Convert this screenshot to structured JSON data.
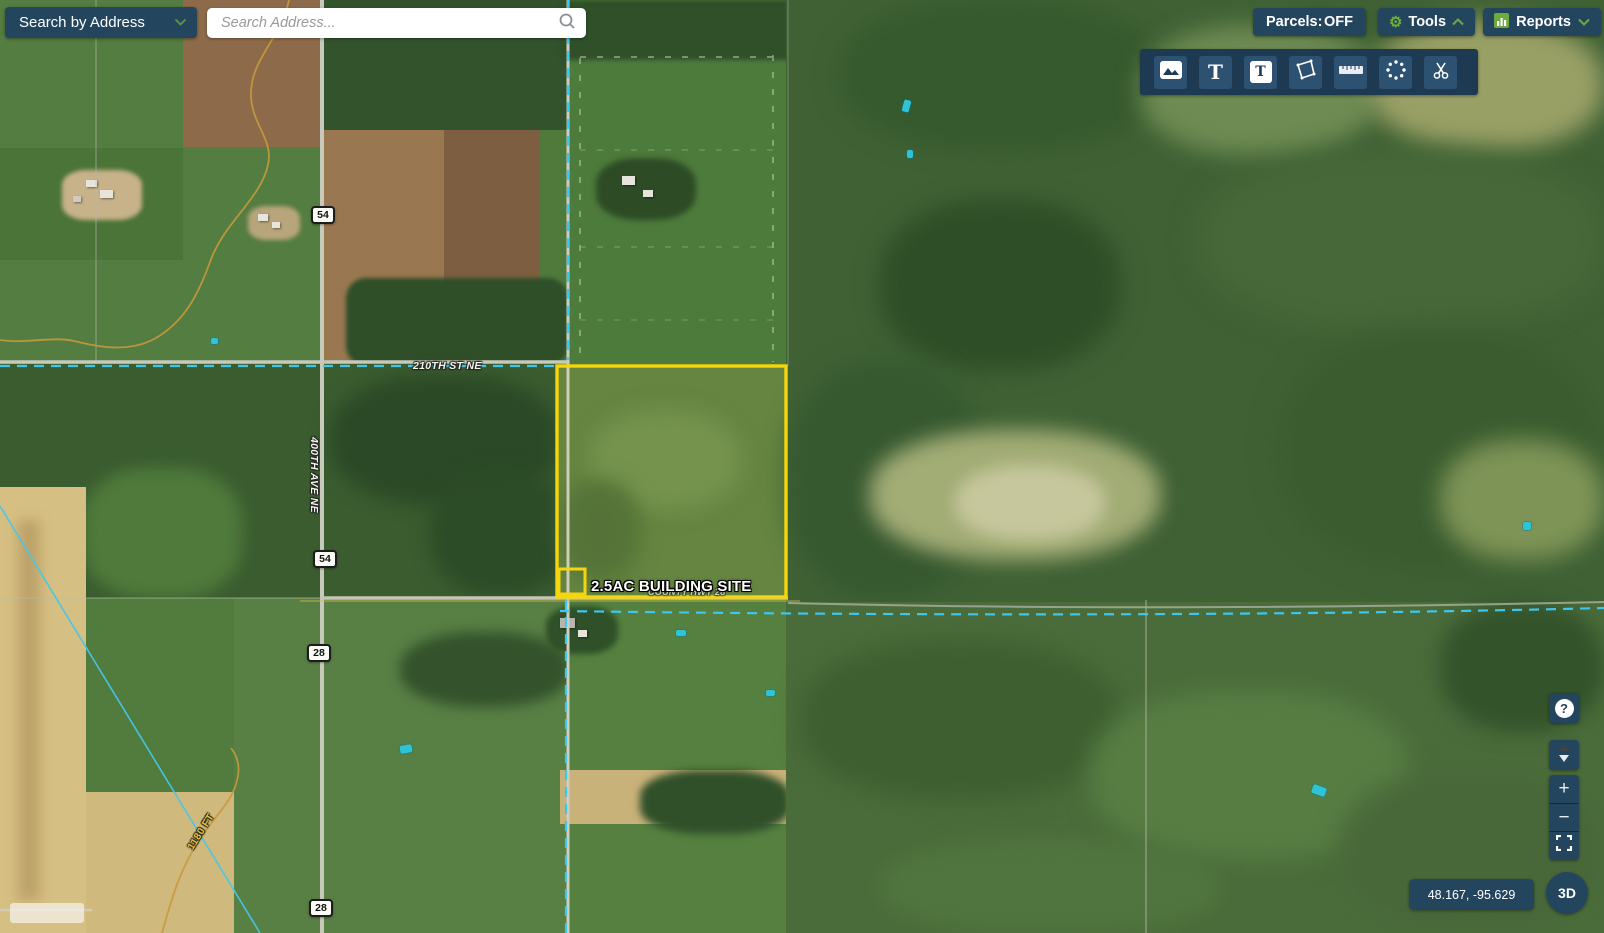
{
  "search": {
    "mode_button_label": "Search by Address",
    "placeholder": "Search Address..."
  },
  "topbar": {
    "parcels_label": "Parcels:",
    "parcels_state": "OFF",
    "tools_label": "Tools",
    "reports_label": "Reports"
  },
  "toolbar": {
    "text_tool_glyph": "T",
    "text_box_tool_glyph": "T"
  },
  "map": {
    "site_label": "2.5AC BUILDING SITE",
    "road_210": "210TH ST NE",
    "road_400": "400TH AVE NE",
    "road_hwy": "COUNTY HWY 28",
    "shields": [
      {
        "number": "54"
      },
      {
        "number": "54"
      },
      {
        "number": "28"
      },
      {
        "number": "28"
      }
    ],
    "contour_label": "1180 FT"
  },
  "controls": {
    "help_glyph": "?",
    "zoom_in_glyph": "+",
    "zoom_out_glyph": "−",
    "coordinates": "48.167, -95.629",
    "view_3d_label": "3D"
  },
  "colors": {
    "panel_navy": "#24455e",
    "accent_green": "#6cab3e",
    "parcel_yellow": "#f6d60a",
    "boundary_cyan": "#3fc6ef"
  }
}
